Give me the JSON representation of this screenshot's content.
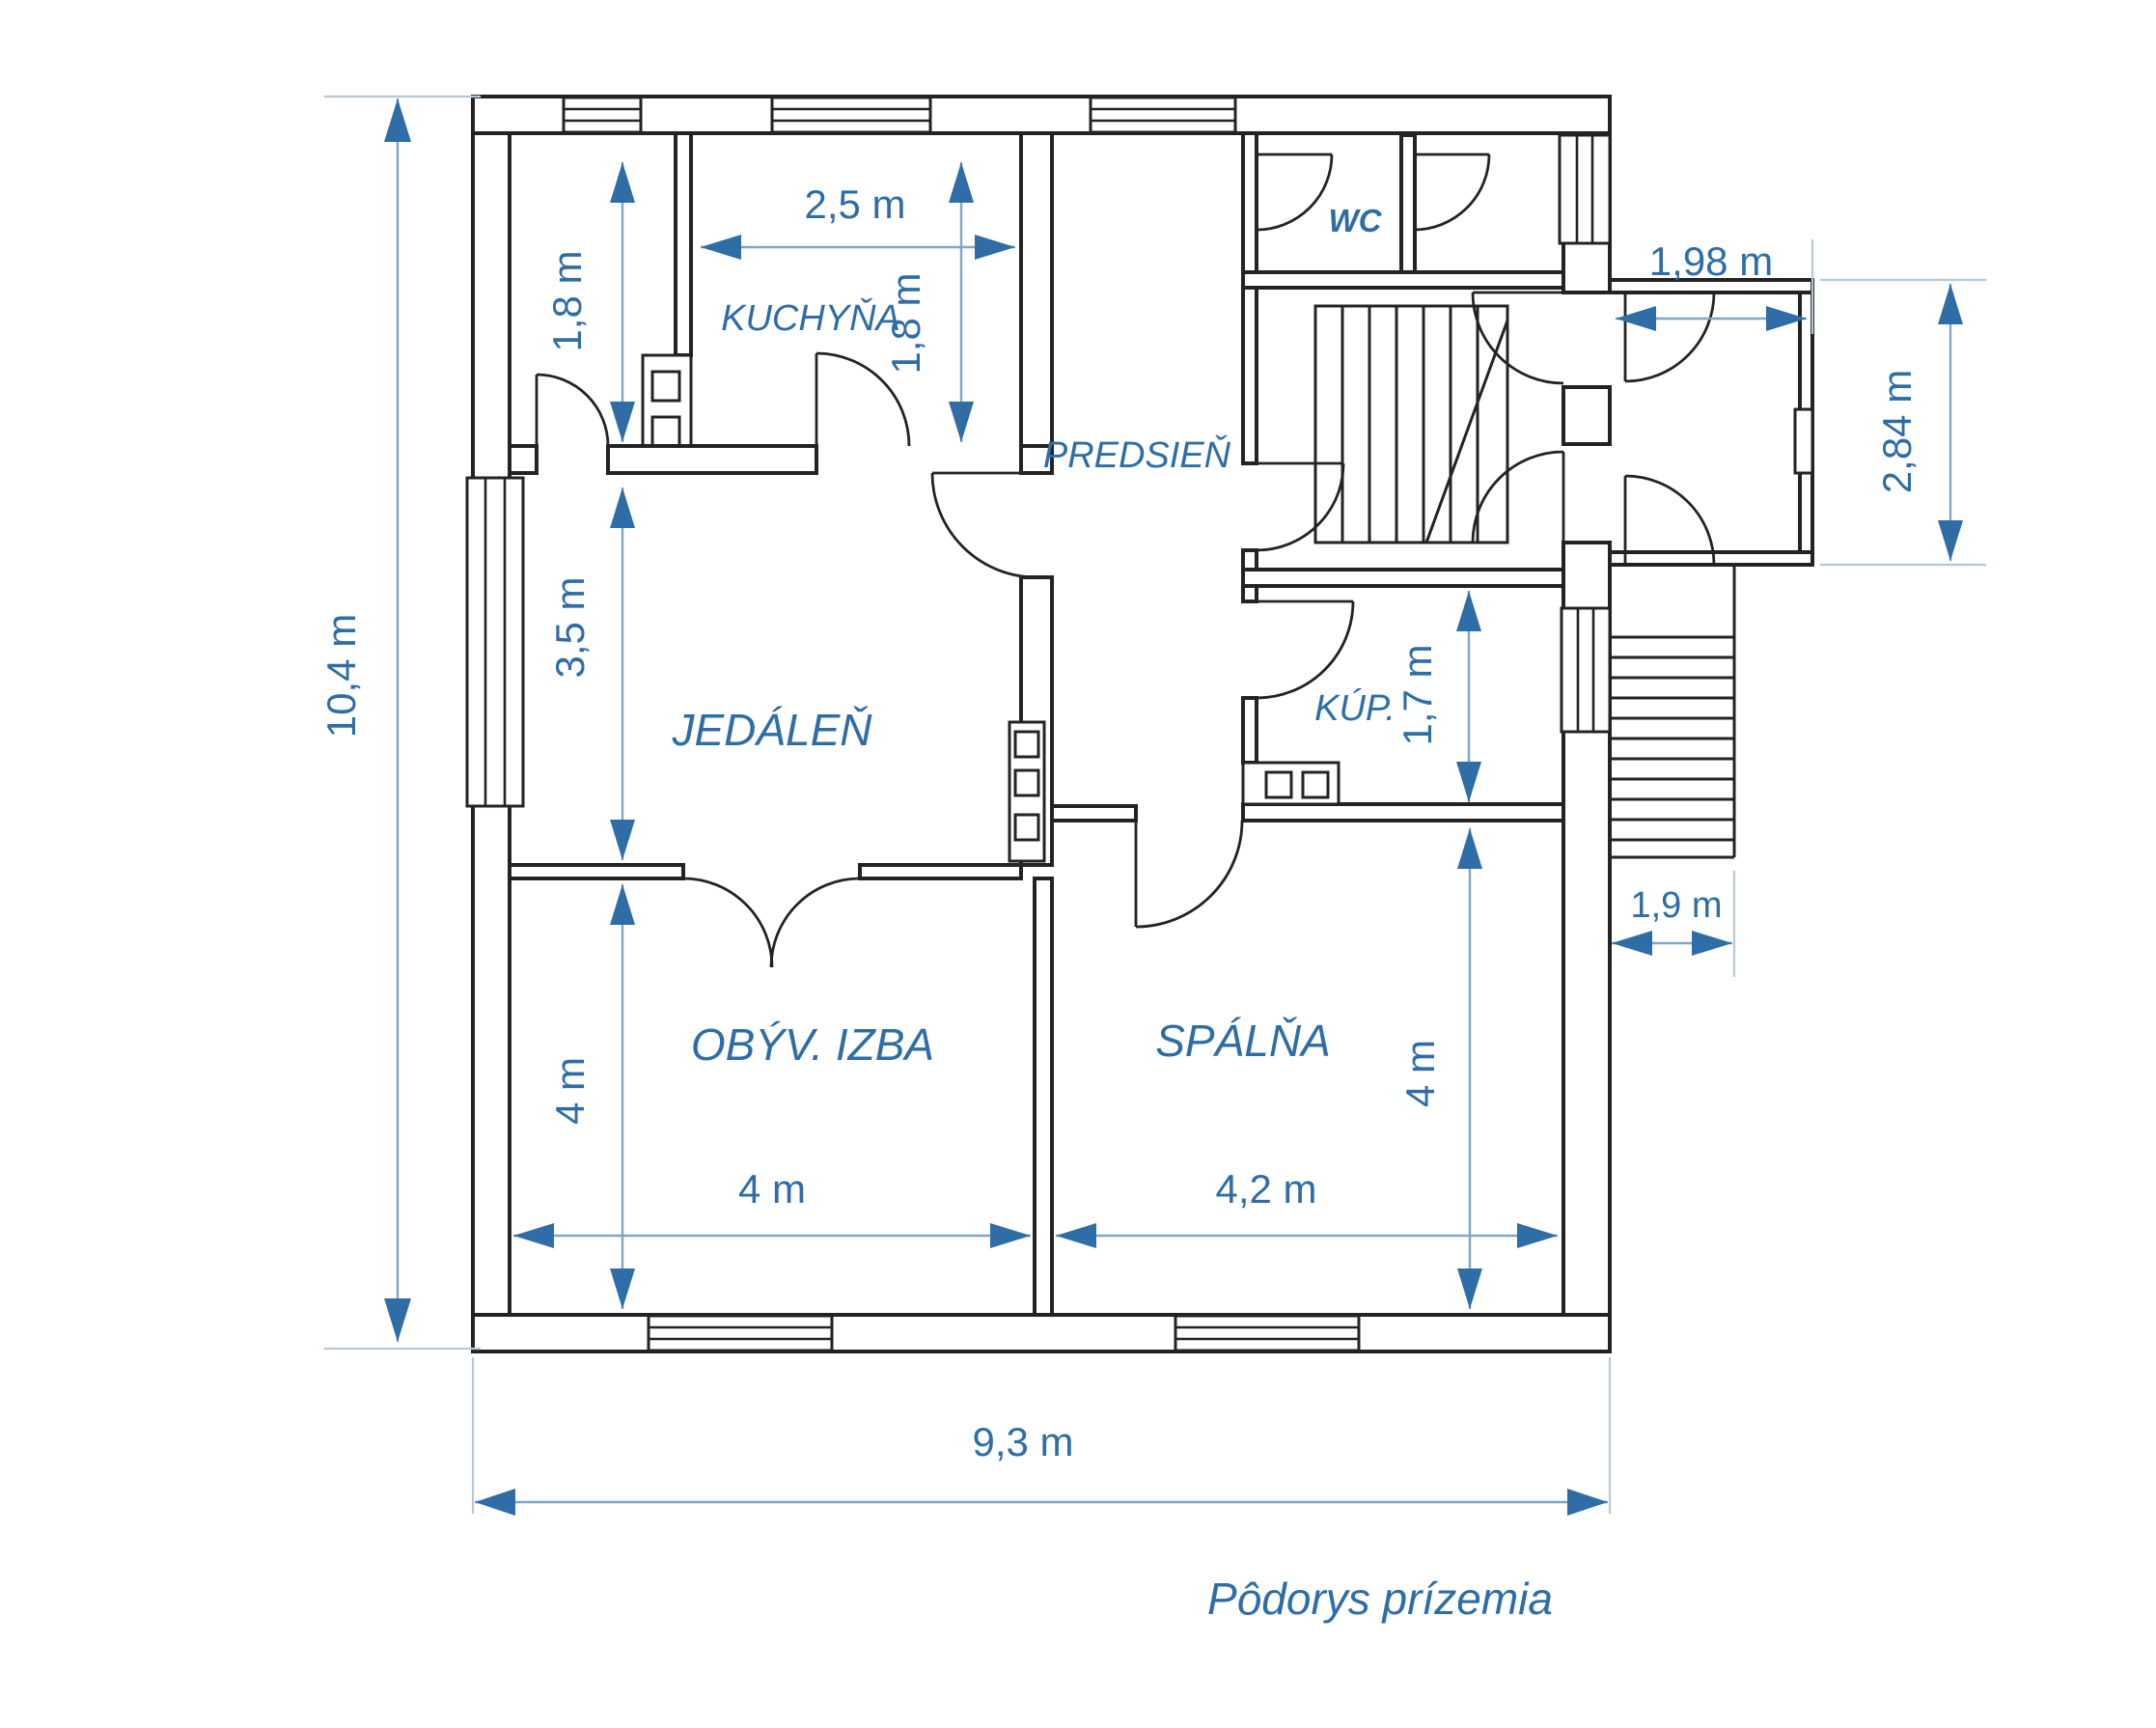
{
  "title": "Pôdorys prízemia",
  "colors": {
    "walls": "#232323",
    "annotation": "#2e6da5",
    "dimension_line": "#7fa6c6",
    "extension_line": "#b7c9d8",
    "background": "#ffffff"
  },
  "rooms": [
    {
      "id": "kuchyna",
      "label": "KUCHYŇA"
    },
    {
      "id": "predsien",
      "label": "PREDSIEŇ"
    },
    {
      "id": "wc",
      "label": "WC"
    },
    {
      "id": "jedalen",
      "label": "JEDÁLEŇ"
    },
    {
      "id": "kupelna",
      "label": "KÚP."
    },
    {
      "id": "obyvacia",
      "label": "OBÝV. IZBA"
    },
    {
      "id": "spalna",
      "label": "SPÁLŇA"
    }
  ],
  "dimensions": {
    "height_total": "10,4 m",
    "width_total": "9,3 m",
    "kitchen_width": "2,5 m",
    "pantry_depth": "1,8 m",
    "kitchen_depth": "1,8 m",
    "dining_depth": "3,5 m",
    "porch_width": "1,98 m",
    "porch_depth": "2,84 m",
    "bath_depth": "1,7 m",
    "stairs_width": "1,9 m",
    "living_depth": "4 m",
    "living_width": "4 m",
    "bedroom_width": "4,2 m",
    "bedroom_depth": "4 m"
  }
}
